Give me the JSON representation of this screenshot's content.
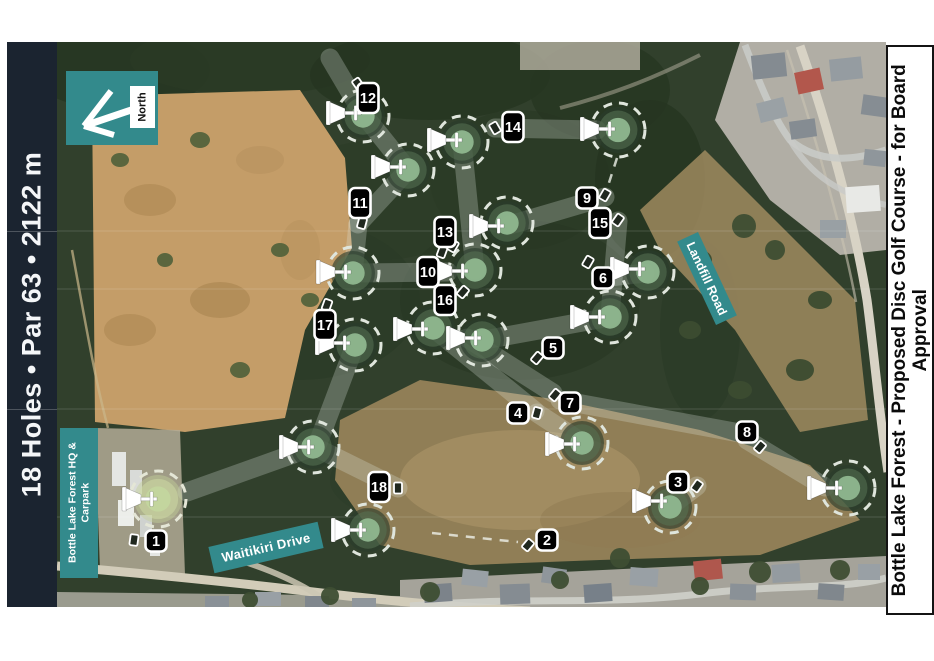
{
  "left_sidebar": {
    "text": "18 Holes  •  Par 63  •  2122 m",
    "bg": "#1b2430",
    "fg": "#f4f6f8"
  },
  "right_panel": {
    "text": "Bottle Lake Forest - Proposed Disc Golf Course - for Board Approval",
    "bg": "#ffffff",
    "fg": "#0b0b0b"
  },
  "north": {
    "label": "North",
    "bg": "#338a8c"
  },
  "map": {
    "labels": {
      "hq": {
        "text": "Bottle Lake Forest HQ & Carpark"
      },
      "waitikiri": {
        "text": "Waitikiri Drive"
      },
      "landfill": {
        "text": "Landfill Road"
      }
    },
    "colors": {
      "teal": "#338a8c",
      "chip_bg": "#000000",
      "chip_fg": "#ffffff",
      "green_dash": "#dfe5dc",
      "basket": "#ffffff",
      "forest": "#31402c"
    },
    "chips": [
      {
        "n": "1",
        "x": 156,
        "y": 541
      },
      {
        "n": "2",
        "x": 547,
        "y": 540
      },
      {
        "n": "3",
        "x": 678,
        "y": 482
      },
      {
        "n": "4",
        "x": 518,
        "y": 413
      },
      {
        "n": "5",
        "x": 553,
        "y": 348
      },
      {
        "n": "6",
        "x": 603,
        "y": 278
      },
      {
        "n": "7",
        "x": 570,
        "y": 403
      },
      {
        "n": "8",
        "x": 747,
        "y": 432
      },
      {
        "n": "9",
        "x": 587,
        "y": 198
      },
      {
        "n": "10",
        "x": 428,
        "y": 272
      },
      {
        "n": "11",
        "x": 360,
        "y": 203
      },
      {
        "n": "12",
        "x": 368,
        "y": 98
      },
      {
        "n": "13",
        "x": 445,
        "y": 232
      },
      {
        "n": "14",
        "x": 513,
        "y": 127
      },
      {
        "n": "15",
        "x": 600,
        "y": 223
      },
      {
        "n": "16",
        "x": 445,
        "y": 300
      },
      {
        "n": "17",
        "x": 325,
        "y": 325
      },
      {
        "n": "18",
        "x": 379,
        "y": 487
      }
    ],
    "tees": [
      [
        134,
        540,
        8
      ],
      [
        528,
        545,
        40
      ],
      [
        697,
        486,
        35
      ],
      [
        537,
        413,
        15
      ],
      [
        537,
        358,
        40
      ],
      [
        588,
        262,
        30
      ],
      [
        555,
        395,
        40
      ],
      [
        760,
        447,
        40
      ],
      [
        605,
        195,
        30
      ],
      [
        442,
        252,
        20
      ],
      [
        362,
        223,
        15
      ],
      [
        358,
        84,
        -35
      ],
      [
        453,
        246,
        30
      ],
      [
        495,
        128,
        -30
      ],
      [
        618,
        220,
        35
      ],
      [
        463,
        292,
        40
      ],
      [
        327,
        305,
        20
      ],
      [
        398,
        488,
        0
      ]
    ],
    "greens": [
      [
        158,
        499,
        28,
        1
      ],
      [
        313,
        447,
        26,
        0
      ],
      [
        368,
        530,
        26,
        0
      ],
      [
        582,
        443,
        26,
        0
      ],
      [
        670,
        507,
        26,
        0
      ],
      [
        848,
        488,
        27,
        0
      ],
      [
        363,
        116,
        26,
        0
      ],
      [
        408,
        170,
        26,
        0
      ],
      [
        462,
        142,
        26,
        0
      ],
      [
        618,
        130,
        27,
        0
      ],
      [
        507,
        223,
        26,
        0
      ],
      [
        475,
        270,
        26,
        0
      ],
      [
        353,
        273,
        26,
        0
      ],
      [
        433,
        328,
        26,
        0
      ],
      [
        482,
        340,
        26,
        0
      ],
      [
        355,
        345,
        26,
        0
      ],
      [
        648,
        272,
        26,
        0
      ],
      [
        610,
        317,
        26,
        0
      ]
    ],
    "baskets": [
      [
        141,
        499
      ],
      [
        298,
        447
      ],
      [
        350,
        530
      ],
      [
        564,
        444
      ],
      [
        651,
        501
      ],
      [
        826,
        488
      ],
      [
        345,
        113
      ],
      [
        390,
        167
      ],
      [
        446,
        140
      ],
      [
        599,
        129
      ],
      [
        488,
        226
      ],
      [
        452,
        271
      ],
      [
        335,
        272
      ],
      [
        412,
        329
      ],
      [
        465,
        338
      ],
      [
        334,
        343
      ],
      [
        629,
        269
      ],
      [
        589,
        317
      ]
    ],
    "fairways": [
      [
        330,
        58,
        363,
        114
      ],
      [
        363,
        114,
        408,
        170
      ],
      [
        408,
        170,
        358,
        224
      ],
      [
        358,
        224,
        353,
        273
      ],
      [
        353,
        273,
        448,
        272
      ],
      [
        462,
        142,
        475,
        270
      ],
      [
        495,
        128,
        597,
        130
      ],
      [
        605,
        197,
        510,
        225
      ],
      [
        618,
        221,
        610,
        315
      ],
      [
        610,
        317,
        484,
        340
      ],
      [
        433,
        328,
        535,
        411
      ],
      [
        467,
        338,
        553,
        393
      ],
      [
        537,
        413,
        580,
        441
      ],
      [
        560,
        400,
        745,
        434
      ],
      [
        747,
        440,
        825,
        487
      ],
      [
        697,
        486,
        672,
        505
      ],
      [
        398,
        488,
        315,
        447
      ],
      [
        313,
        447,
        187,
        492
      ],
      [
        355,
        345,
        318,
        443
      ],
      [
        601,
        278,
        645,
        273
      ]
    ],
    "dashed_lines": [
      [
        432,
        533,
        518,
        542
      ],
      [
        617,
        158,
        606,
        192
      ]
    ]
  }
}
